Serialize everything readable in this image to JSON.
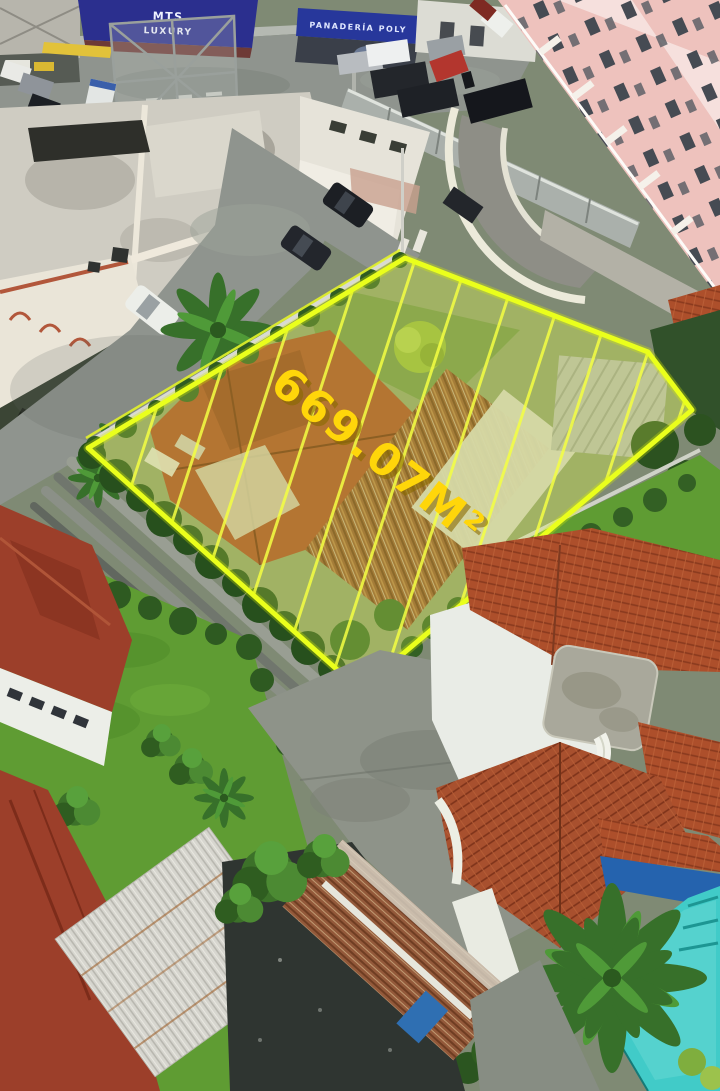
{
  "overlay": {
    "area_label": "669.07M²",
    "outline_color": "#eaff1c",
    "fill_color": "#e9ff52",
    "label_color": "#ffd60a",
    "hatch_color": "#f4ff42"
  },
  "signs": {
    "billboard_line1": "MTS",
    "billboard_line2": "LUXURY",
    "billboard_bg": "#2b2f8e",
    "storefront_banner": "PANADERÍA POLY",
    "banner_bg": "#27379b"
  },
  "colors": {
    "pool": "#41cbc8",
    "terracotta_roof": "#ad4f2b",
    "lawn": "#5f9c33",
    "lot_hedge": "#2f5b22"
  }
}
